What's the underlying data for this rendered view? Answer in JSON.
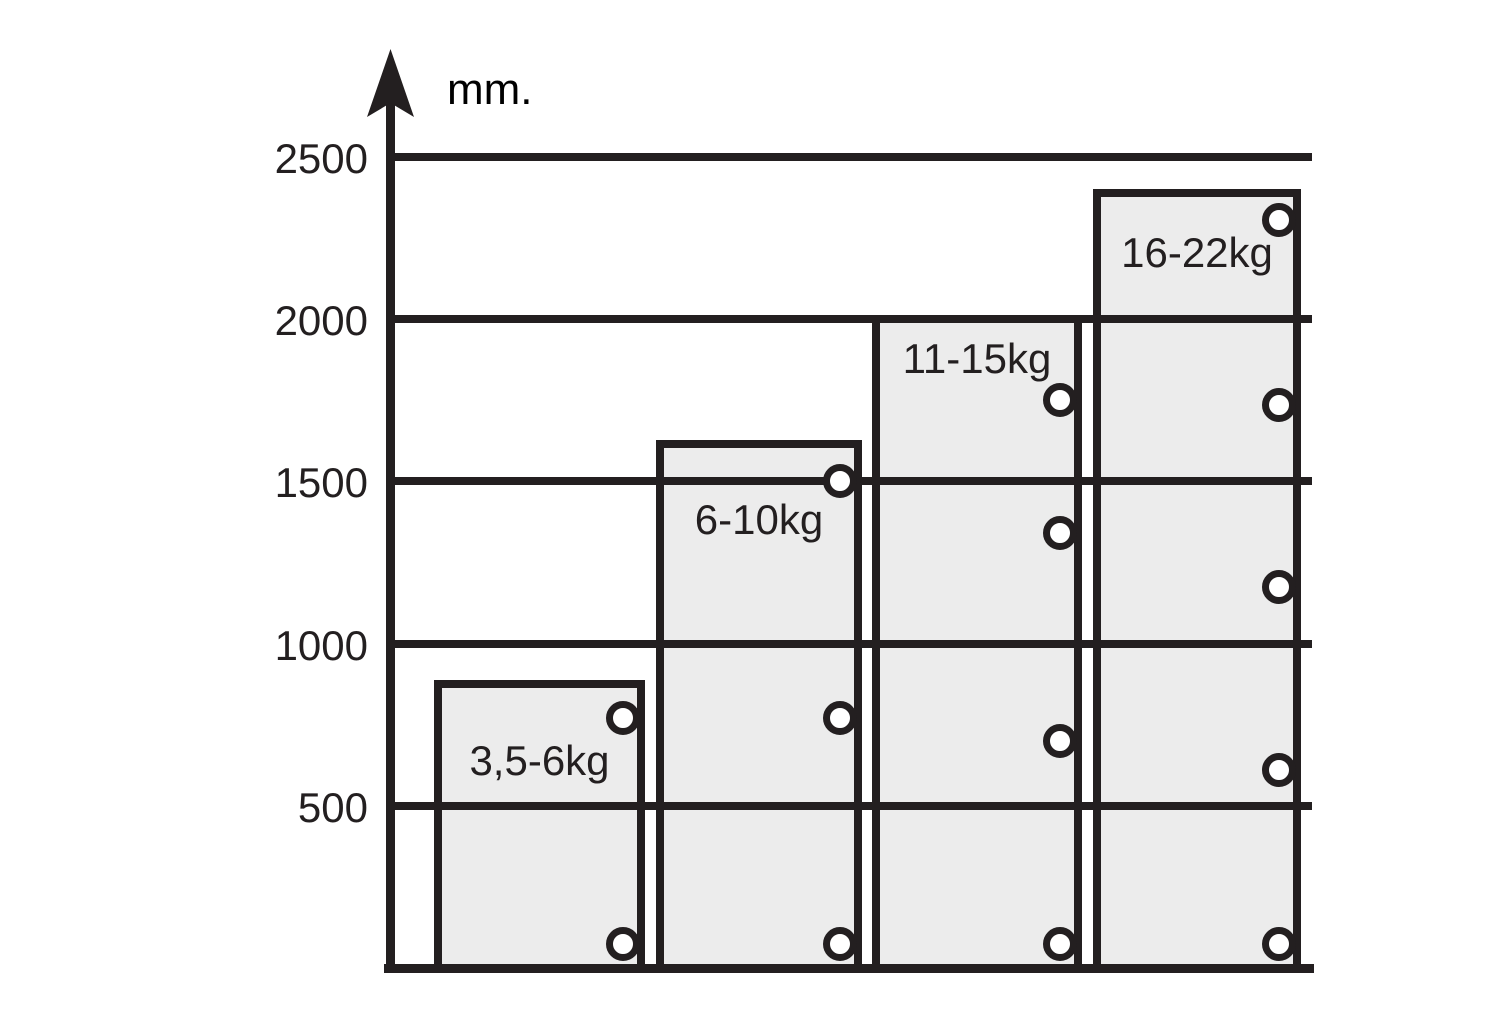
{
  "figure": {
    "description": "Weight range vs. height technical bar chart",
    "unit_label": "mm."
  },
  "axis": {
    "unit_label": "mm.",
    "ticks": [
      "2500",
      "2000",
      "1500",
      "1000",
      "500"
    ],
    "tick_values": [
      2500,
      2000,
      1500,
      1000,
      500
    ],
    "max_mm": 2500
  },
  "chart_data": {
    "type": "bar",
    "title": "",
    "xlabel": "",
    "ylabel": "mm.",
    "ylim": [
      0,
      2500
    ],
    "grid": "horizontal",
    "legend": "none",
    "categories": [
      "3,5-6kg",
      "6-10kg",
      "11-15kg",
      "16-22kg"
    ],
    "values": [
      875,
      1615,
      2000,
      2390
    ],
    "hole_markers_mm": [
      [
        770,
        75
      ],
      [
        1500,
        770,
        75
      ],
      [
        1750,
        1340,
        700,
        75
      ],
      [
        2305,
        1735,
        1175,
        610,
        75
      ]
    ]
  },
  "colors": {
    "ink": "#231f20",
    "bar_fill": "#ececec",
    "hole_fill": "#ffffff",
    "background": "#ffffff"
  }
}
